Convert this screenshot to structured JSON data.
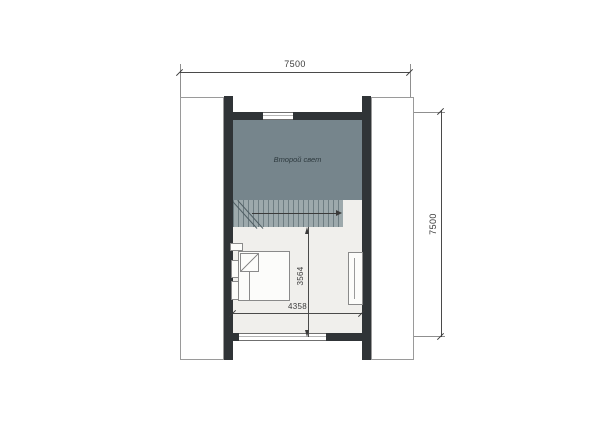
{
  "drawing": {
    "room_label": "Второй свет",
    "dim_top": "7500",
    "dim_right": "7500",
    "dim_inner_width": "4358",
    "dim_inner_height": "3564"
  },
  "colors": {
    "wall": "#303437",
    "void_fill": "#76858C",
    "stair_fill": "#9DA9AC",
    "floor_fill": "#F0EFEC",
    "roof_fill": "#FFFFFF",
    "dim_line": "#4A4A4A",
    "furniture_outline": "#8A8A8A",
    "background": "#FFFFFF"
  }
}
